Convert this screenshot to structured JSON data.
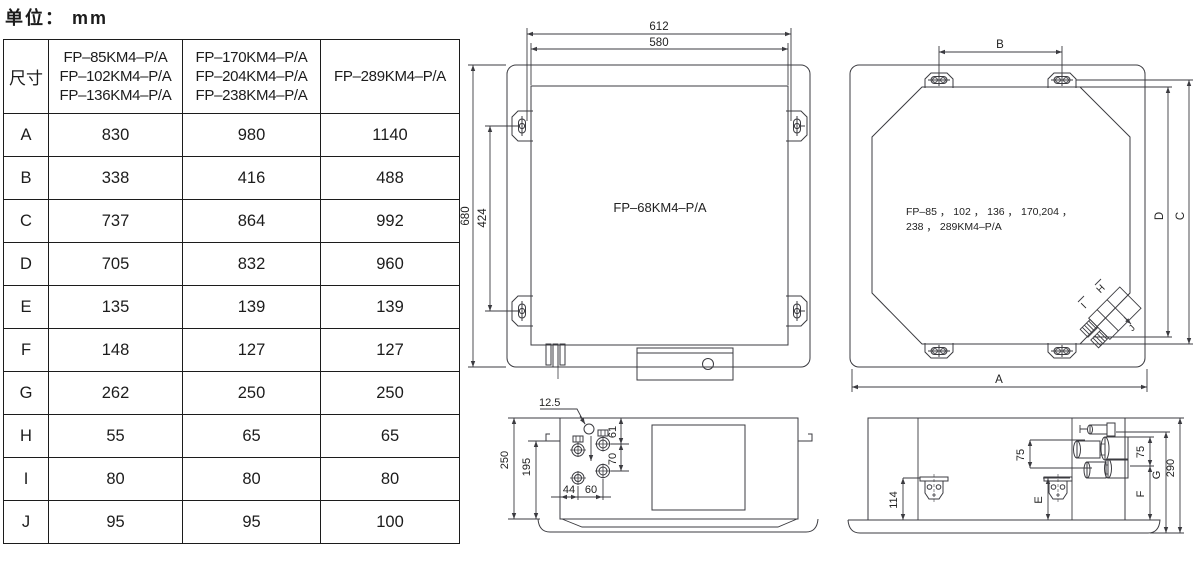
{
  "unit_label": "单位： mm",
  "table": {
    "corner_header": "尺寸",
    "col_headers": [
      [
        "FP–85KM4–P/A",
        "FP–102KM4–P/A",
        "FP–136KM4–P/A"
      ],
      [
        "FP–170KM4–P/A",
        "FP–204KM4–P/A",
        "FP–238KM4–P/A"
      ],
      [
        "FP–289KM4–P/A"
      ]
    ],
    "rows": [
      {
        "dim": "A",
        "v": [
          "830",
          "980",
          "1140"
        ]
      },
      {
        "dim": "B",
        "v": [
          "338",
          "416",
          "488"
        ]
      },
      {
        "dim": "C",
        "v": [
          "737",
          "864",
          "992"
        ]
      },
      {
        "dim": "D",
        "v": [
          "705",
          "832",
          "960"
        ]
      },
      {
        "dim": "E",
        "v": [
          "135",
          "139",
          "139"
        ]
      },
      {
        "dim": "F",
        "v": [
          "148",
          "127",
          "127"
        ]
      },
      {
        "dim": "G",
        "v": [
          "262",
          "250",
          "250"
        ]
      },
      {
        "dim": "H",
        "v": [
          "55",
          "65",
          "65"
        ]
      },
      {
        "dim": "I",
        "v": [
          "80",
          "80",
          "80"
        ]
      },
      {
        "dim": "J",
        "v": [
          "95",
          "95",
          "100"
        ]
      }
    ]
  },
  "drawings": {
    "top_view_small": {
      "model": "FP–68KM4–P/A",
      "dim_outer_width": "612",
      "dim_inner_width": "580",
      "dim_outer_height": "680",
      "dim_bracket_height": "424"
    },
    "top_view_large": {
      "model_line1": "FP–85 ， 102 ， 136 ， 170,204 ，",
      "model_line2": "238 ， 289KM4–P/A",
      "dim_b": "B",
      "dim_a": "A",
      "dim_c": "C",
      "dim_d": "D",
      "dim_h": "H",
      "dim_i": "I",
      "dim_j": "J"
    },
    "side_view_small": {
      "dim_drain": "12.5",
      "dim_height": "250",
      "dim_hook": "195",
      "dim_61": "61",
      "dim_70": "70",
      "dim_44": "44",
      "dim_60": "60"
    },
    "side_view_large": {
      "dim_114": "114",
      "dim_e": "E",
      "dim_75_left": "75",
      "dim_75_right": "75",
      "dim_f": "F",
      "dim_g": "G",
      "dim_290": "290"
    }
  }
}
